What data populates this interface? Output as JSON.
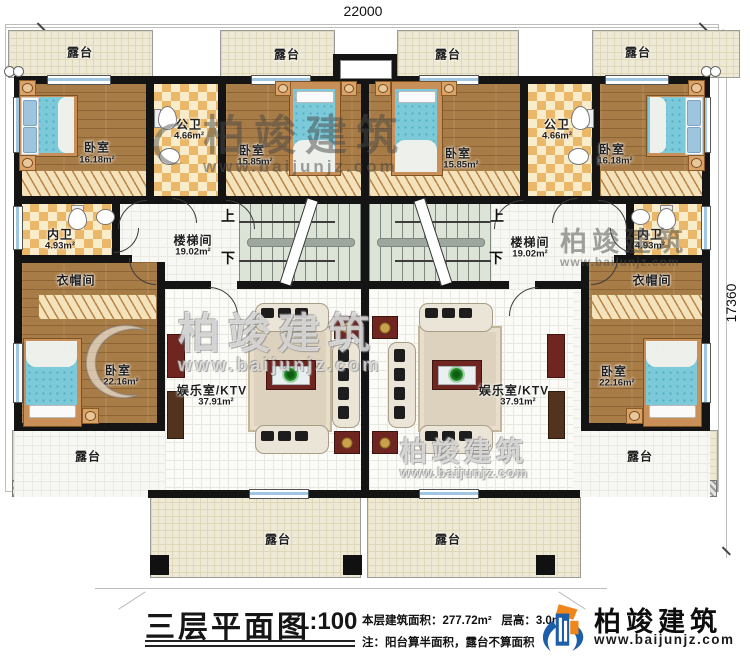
{
  "dimensions": {
    "width_mm": "22000",
    "height_mm": "17360"
  },
  "rooms": {
    "terrace": "露台",
    "bedroom": "卧室",
    "public_bath": "公卫",
    "private_bath": "内卫",
    "cloakroom": "衣帽间",
    "stairwell": "楼梯间",
    "ktv": "娱乐室/KTV",
    "up": "上",
    "down": "下"
  },
  "areas": {
    "bedroom_a": "16.18m²",
    "bedroom_b": "15.85m²",
    "bedroom_c": "22.16m²",
    "public_bath": "4.66m²",
    "private_bath": "4.93m²",
    "stairwell": "19.02m²",
    "ktv": "37.91m²"
  },
  "title_block": {
    "title": "三层平面图",
    "scale": "1:100",
    "floor_area": "本层建筑面积：277.72m²",
    "floor_height": "层高：3.0m",
    "note": "注：阳台算半面积，露台不算面积"
  },
  "brand": {
    "name": "柏竣建筑",
    "url": "www.baijunjz.com"
  },
  "colors": {
    "wall": "#141414",
    "wood": "#a87c46",
    "terrace": "#eee9d4",
    "tile": "#eab868",
    "stair": "#dce3d7",
    "bed": "#7cc9d9",
    "maroon": "#6f2520",
    "logo_blue": "#1c5fa8",
    "logo_orange": "#f08519"
  }
}
